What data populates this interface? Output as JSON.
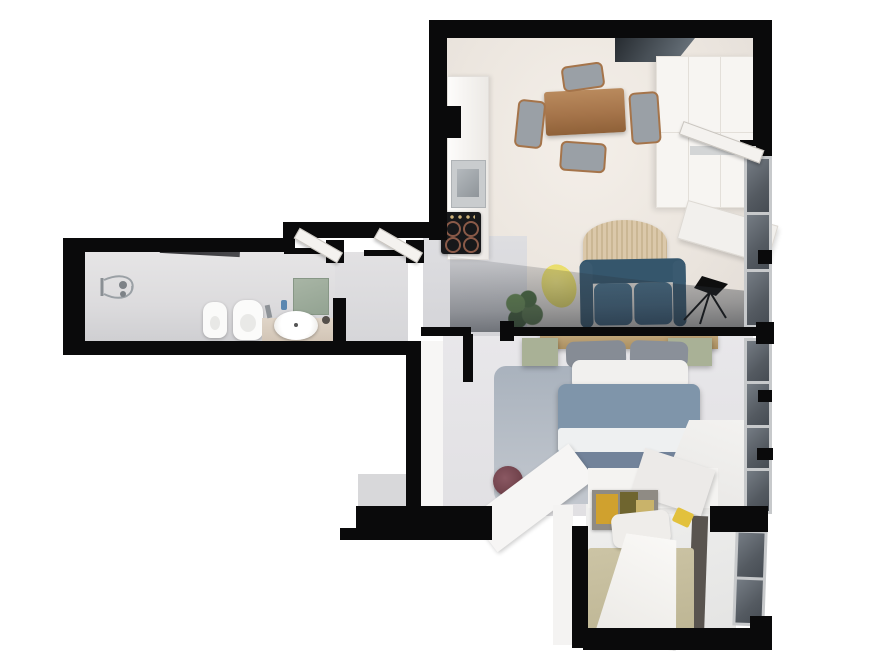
{
  "title": "apartment-3d-floor-plan",
  "palette": {
    "wall_black": "#0a0a0b",
    "floor_cream": "#efe9e3",
    "floor_gray": "#e5e4e7",
    "window_glass": "#5d636b",
    "window_frame": "#c7c9cb",
    "skylight_glass": "#2f353b",
    "table_wood": "#a5744a",
    "headboard_wood": "#b59a6d",
    "sofa_teal": "#3e6077",
    "bed_blue": "#7f95aa",
    "bed_blue_dark": "#72839a",
    "sage_green": "#a9b196",
    "mirror_sage": "#9fae9e",
    "rug_yellow": "#e9dd67",
    "art_yellow": "#d0a12e",
    "bedspread_olive": "#c3bb9b",
    "pouf_maroon": "#7a4b55",
    "plant_green": "#5d7a4d",
    "arch_tan": "#d6c0a2",
    "area_rug_gray": "#b2bac4"
  },
  "rooms": [
    {
      "id": "dining-kitchen",
      "label": "dining and kitchen",
      "furniture": [
        "dining-table",
        "dining-chair x4",
        "kitchen-counter",
        "kitchen-sink",
        "cooktop",
        "wardrobe",
        "skylight-glass",
        "balcony-door"
      ]
    },
    {
      "id": "bathroom-wing",
      "label": "bathroom corridor",
      "furniture": [
        "shower-fixture",
        "shower-glass",
        "ceiling-beam",
        "bidet",
        "toilet",
        "vanity-counter",
        "vessel-sink",
        "sage-mirror",
        "hall-door x2"
      ]
    },
    {
      "id": "living-room",
      "label": "living room",
      "furniture": [
        "sofa",
        "arch-wall-decor",
        "yellow-rug",
        "potted-plant",
        "floor-lamp",
        "glass-partition",
        "window-strip"
      ]
    },
    {
      "id": "master-bedroom",
      "label": "master bedroom",
      "furniture": [
        "double-bed",
        "wood-headboard",
        "sage-nightstand x2",
        "gray-pillow x2",
        "white-pillow",
        "area-rug",
        "maroon-pouf",
        "window-strip"
      ]
    },
    {
      "id": "bedroom-2",
      "label": "second bedroom",
      "furniture": [
        "single-bed",
        "white-duvet",
        "olive-bedspread",
        "wall-art",
        "yellow-wall-lamp",
        "window-strip"
      ]
    }
  ]
}
